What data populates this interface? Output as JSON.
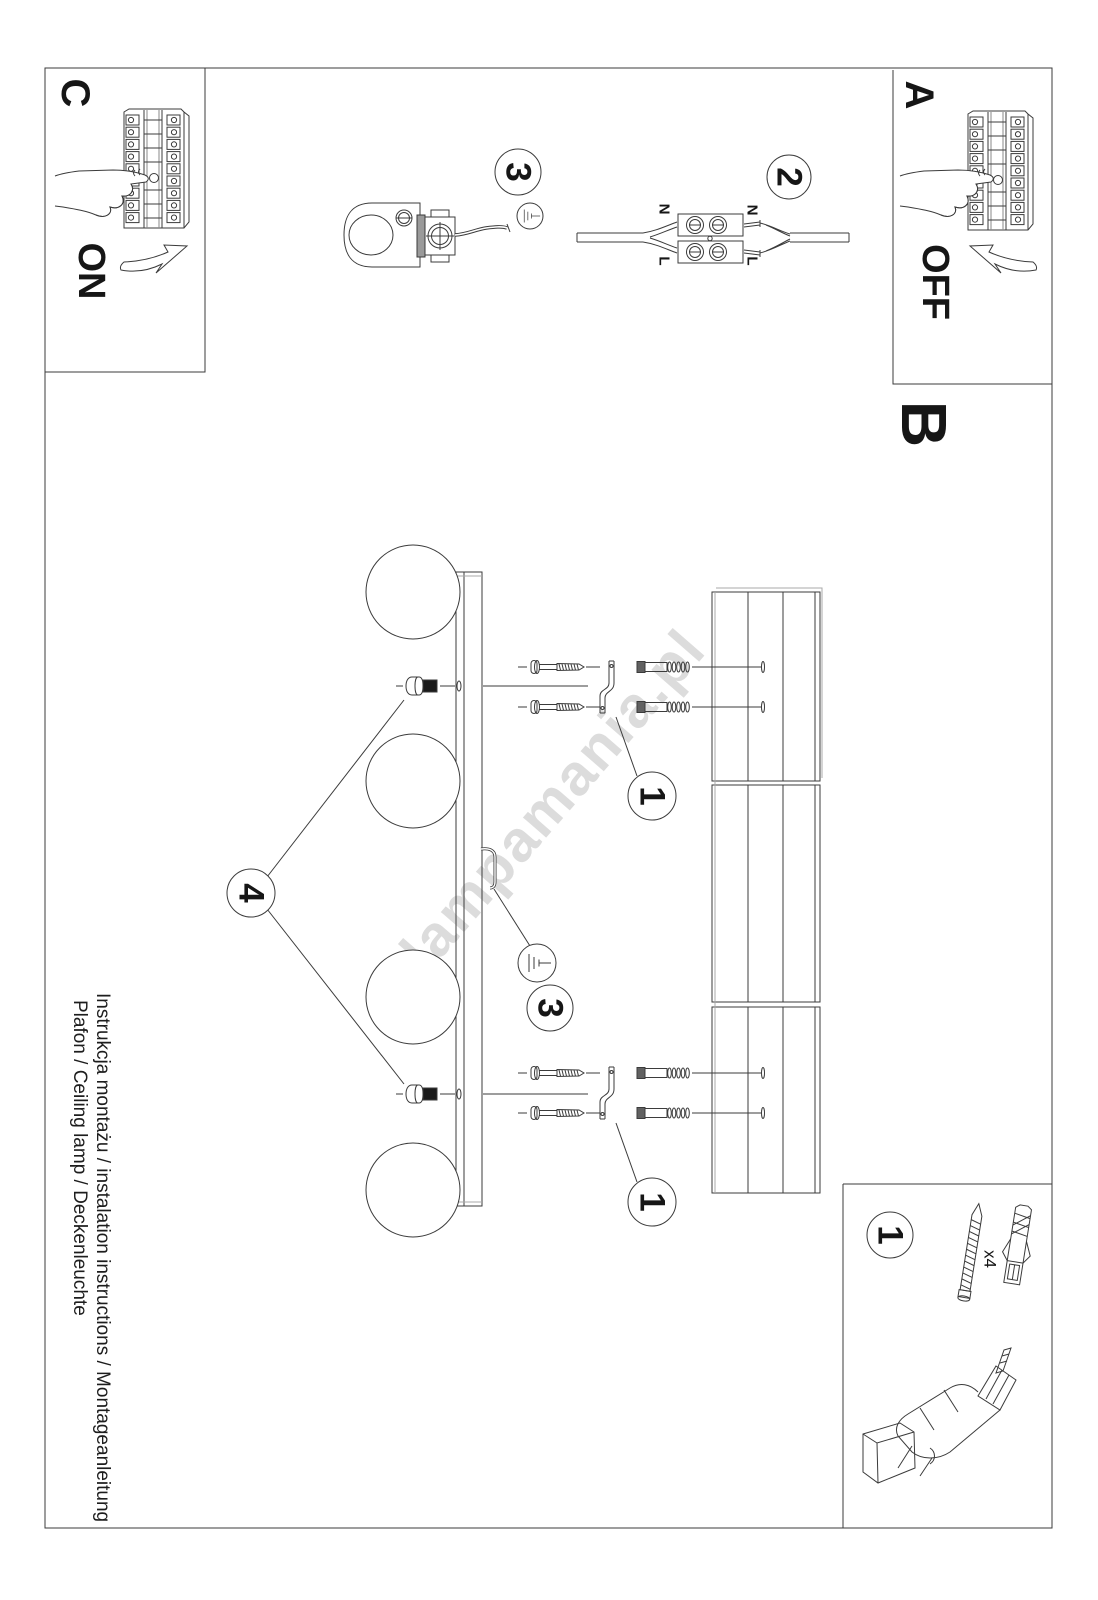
{
  "sections": {
    "a": {
      "label": "A",
      "switch_state": "OFF"
    },
    "b": {
      "label": "B"
    },
    "c": {
      "label": "C",
      "switch_state": "ON"
    }
  },
  "steps": {
    "s1": "1",
    "s2": "2",
    "s3": "3",
    "s4": "4"
  },
  "wiring": {
    "neutral": "N",
    "live": "L"
  },
  "hardware": {
    "screw_quantity": "x4"
  },
  "watermark": "lampamania.pl",
  "footer": {
    "line1": "Instrukcja montażu / instalation instructions / Montageanleitung",
    "line2": "Plafon / Ceiling lamp / Deckenleuchte"
  },
  "colors": {
    "line": "#3b3b3b",
    "watermark": "#dcdcdc",
    "paper": "#ffffff"
  }
}
